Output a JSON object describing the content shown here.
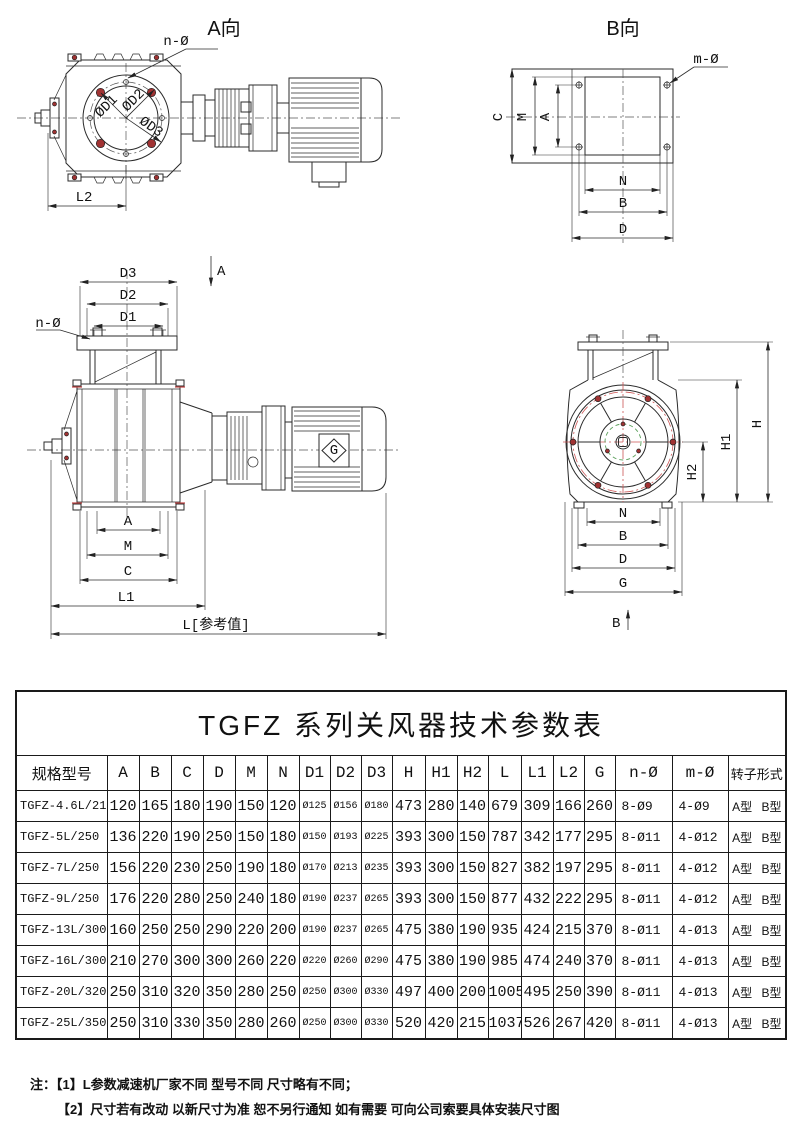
{
  "colors": {
    "line": "#2b2b2b",
    "bolt_red": "#a03232",
    "center_red": "#cc5555",
    "hub_green": "#5ca05c"
  },
  "views": {
    "view_a": {
      "title": "A向",
      "n_phi": "n-Ø",
      "d1": "ØD1",
      "d2": "ØD2",
      "d3": "ØD3",
      "l2": "L2"
    },
    "view_b": {
      "title": "B向",
      "m_phi": "m-Ø",
      "c": "C",
      "m": "M",
      "a": "A",
      "n": "N",
      "b": "B",
      "d": "D"
    },
    "view_front": {
      "section": "A",
      "d3": "D3",
      "d2": "D2",
      "d1": "D1",
      "n_phi": "n-Ø",
      "a": "A",
      "m": "M",
      "c": "C",
      "l1": "L1",
      "l_ref": "L[参考值]",
      "logo": "G"
    },
    "view_side": {
      "section": "B",
      "h": "H",
      "h1": "H1",
      "h2": "H2",
      "n": "N",
      "b": "B",
      "d": "D",
      "g": "G"
    }
  },
  "table": {
    "title": "TGFZ 系列关风器技术参数表",
    "headers": [
      "规格型号",
      "A",
      "B",
      "C",
      "D",
      "M",
      "N",
      "D1",
      "D2",
      "D3",
      "H",
      "H1",
      "H2",
      "L",
      "L1",
      "L2",
      "G",
      "n-Ø",
      "m-Ø",
      "转子形式"
    ],
    "rows": [
      [
        "TGFZ-4.6L/210",
        "120",
        "165",
        "180",
        "190",
        "150",
        "120",
        "Ø125",
        "Ø156",
        "Ø180",
        "473",
        "280",
        "140",
        "679",
        "309",
        "166",
        "260",
        "8-Ø9",
        "4-Ø9",
        "A型 B型"
      ],
      [
        "TGFZ-5L/250",
        "136",
        "220",
        "190",
        "250",
        "150",
        "180",
        "Ø150",
        "Ø193",
        "Ø225",
        "393",
        "300",
        "150",
        "787",
        "342",
        "177",
        "295",
        "8-Ø11",
        "4-Ø12",
        "A型 B型"
      ],
      [
        "TGFZ-7L/250",
        "156",
        "220",
        "230",
        "250",
        "190",
        "180",
        "Ø170",
        "Ø213",
        "Ø235",
        "393",
        "300",
        "150",
        "827",
        "382",
        "197",
        "295",
        "8-Ø11",
        "4-Ø12",
        "A型 B型"
      ],
      [
        "TGFZ-9L/250",
        "176",
        "220",
        "280",
        "250",
        "240",
        "180",
        "Ø190",
        "Ø237",
        "Ø265",
        "393",
        "300",
        "150",
        "877",
        "432",
        "222",
        "295",
        "8-Ø11",
        "4-Ø12",
        "A型 B型"
      ],
      [
        "TGFZ-13L/300",
        "160",
        "250",
        "250",
        "290",
        "220",
        "200",
        "Ø190",
        "Ø237",
        "Ø265",
        "475",
        "380",
        "190",
        "935",
        "424",
        "215",
        "370",
        "8-Ø11",
        "4-Ø13",
        "A型 B型"
      ],
      [
        "TGFZ-16L/300",
        "210",
        "270",
        "300",
        "300",
        "260",
        "220",
        "Ø220",
        "Ø260",
        "Ø290",
        "475",
        "380",
        "190",
        "985",
        "474",
        "240",
        "370",
        "8-Ø11",
        "4-Ø13",
        "A型 B型"
      ],
      [
        "TGFZ-20L/320",
        "250",
        "310",
        "320",
        "350",
        "280",
        "250",
        "Ø250",
        "Ø300",
        "Ø330",
        "497",
        "400",
        "200",
        "1005",
        "495",
        "250",
        "390",
        "8-Ø11",
        "4-Ø13",
        "A型 B型"
      ],
      [
        "TGFZ-25L/350",
        "250",
        "310",
        "330",
        "350",
        "280",
        "260",
        "Ø250",
        "Ø300",
        "Ø330",
        "520",
        "420",
        "215",
        "1037",
        "526",
        "267",
        "420",
        "8-Ø11",
        "4-Ø13",
        "A型 B型"
      ]
    ]
  },
  "notes": {
    "prefix": "注：",
    "line1": "【1】L参数减速机厂家不同 型号不同 尺寸略有不同；",
    "line2": "【2】尺寸若有改动 以新尺寸为准 恕不另行通知 如有需要 可向公司索要具体安装尺寸图"
  }
}
